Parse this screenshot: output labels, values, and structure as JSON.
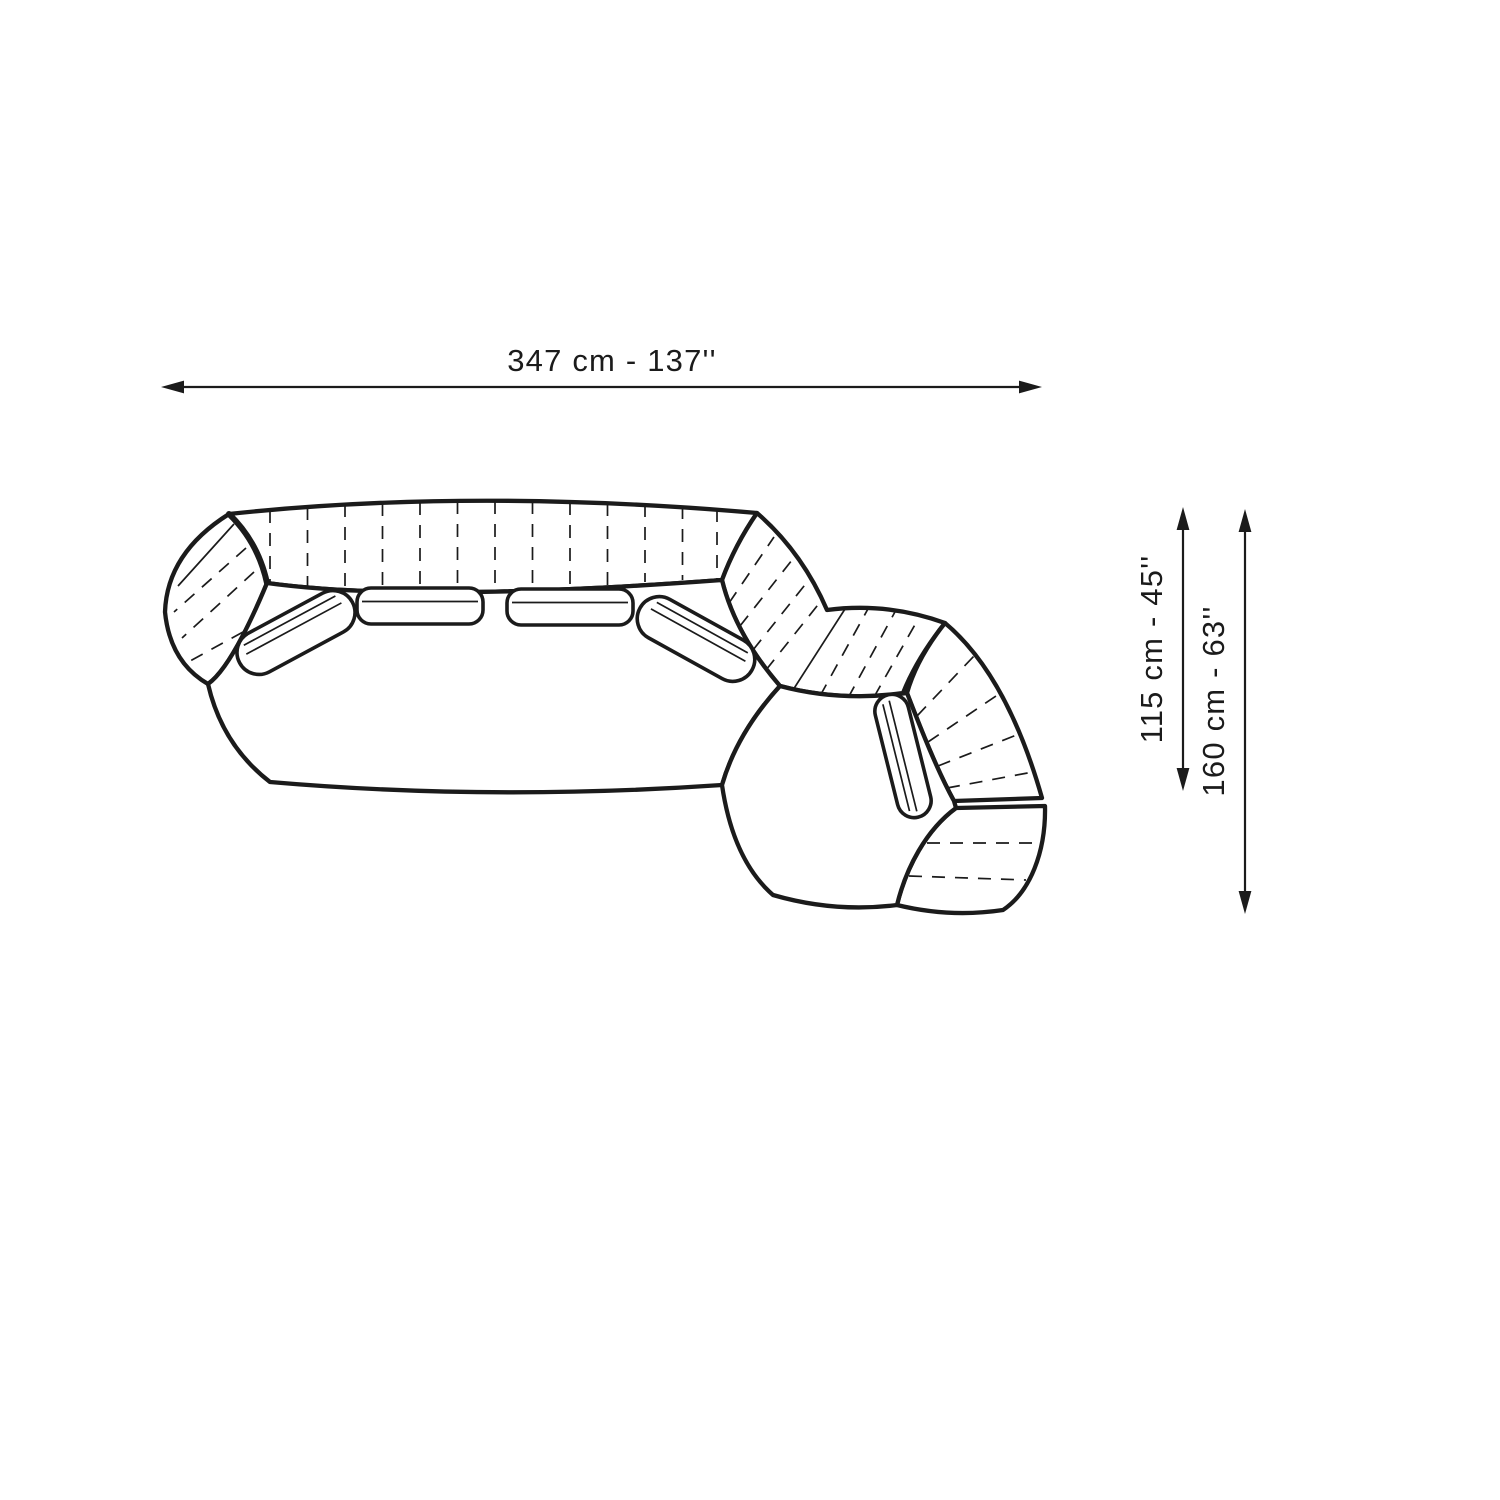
{
  "canvas": {
    "background": "#ffffff",
    "line_color": "#1b1b1b"
  },
  "diagram": {
    "type": "furniture-top-view-dimension-drawing",
    "subject": "modular curved sectional sofa, top view"
  },
  "dimensions": {
    "width": {
      "label": "347 cm - 137''"
    },
    "depth_seat": {
      "label": "115 cm - 45''"
    },
    "depth_total": {
      "label": "160 cm - 63''"
    }
  }
}
